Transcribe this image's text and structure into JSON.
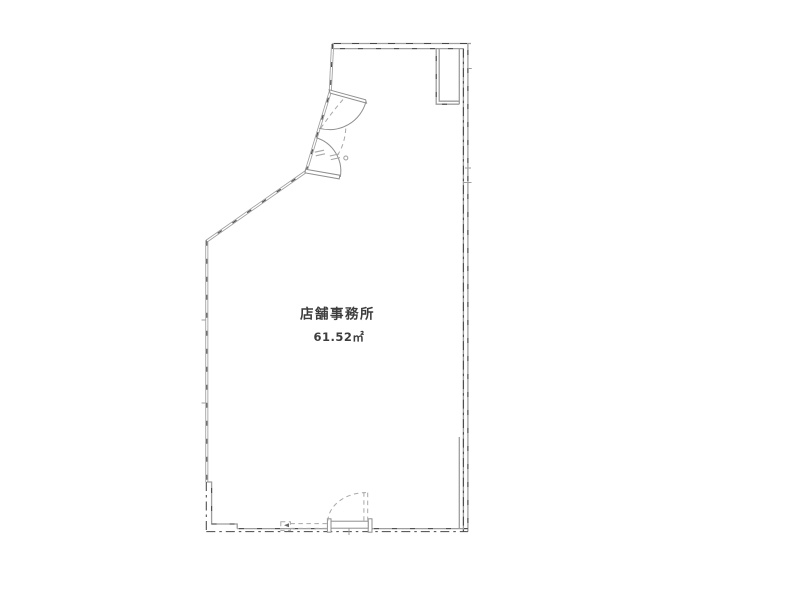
{
  "plan": {
    "room_label": "店舗事務所",
    "area_label": "61.52㎡"
  },
  "colors": {
    "background": "#ffffff",
    "wall": "#9e9e9e",
    "wall_dash": "#474747",
    "door": "#8f8f8f",
    "guide_dash": "#a8a8a8",
    "label_text": "#3d3d3d"
  }
}
